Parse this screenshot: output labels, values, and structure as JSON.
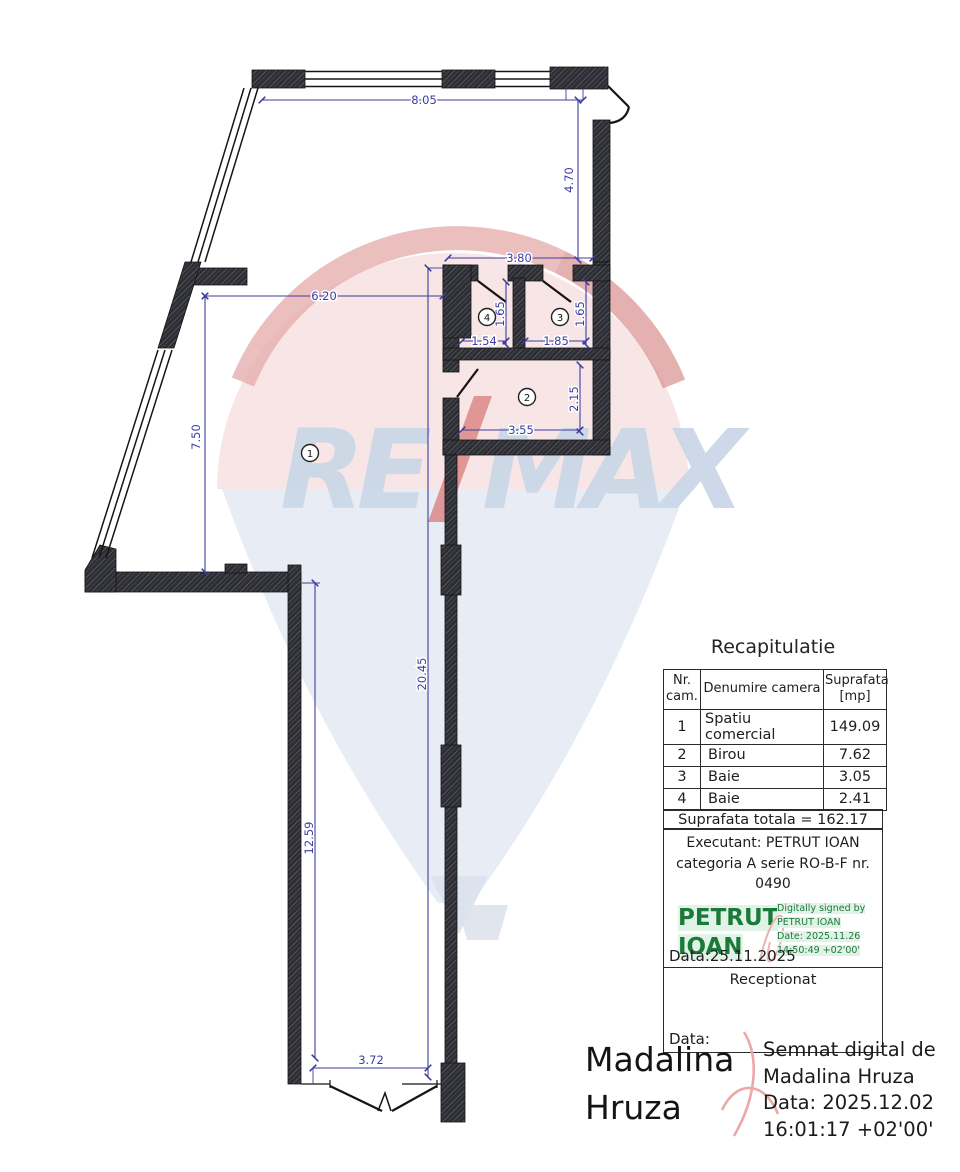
{
  "plan": {
    "dims": {
      "top_width": "8.05",
      "right_upper": "4.70",
      "bath_top": "3.80",
      "room1_width": "6.20",
      "room1_height": "7.50",
      "bath4_height": "1.65",
      "bath3_height": "1.65",
      "bath4_width": "1.54",
      "bath3_width": "1.85",
      "room2_height": "2.15",
      "room2_width": "3.55",
      "corridor_right": "20.45",
      "corridor_left": "12.59",
      "corridor_width": "3.72"
    },
    "rooms": {
      "r1": "1",
      "r2": "2",
      "r3": "3",
      "r4": "4"
    }
  },
  "watermark": {
    "left": "RE",
    "right": "MAX"
  },
  "recap": {
    "title": "Recapitulatie",
    "headers": {
      "nr": "Nr. cam.",
      "name": "Denumire camera",
      "area": "Suprafata [mp]"
    },
    "rows": [
      {
        "nr": "1",
        "name": "Spatiu comercial",
        "area": "149.09"
      },
      {
        "nr": "2",
        "name": "Birou",
        "area": "7.62"
      },
      {
        "nr": "3",
        "name": "Baie",
        "area": "3.05"
      },
      {
        "nr": "4",
        "name": "Baie",
        "area": "2.41"
      }
    ],
    "total": "Suprafata totala = 162.17",
    "executant_line1": "Executant: PETRUT IOAN",
    "executant_line2": "categoria A serie RO-B-F nr. 0490",
    "date_line": "Data:25.11.2025",
    "receptionat": "Receptionat",
    "data_label": "Data:"
  },
  "digital_signature": {
    "name": "PETRUT IOAN",
    "l1": "Digitally signed by",
    "l2": "PETRUT IOAN",
    "l3": "Date: 2025.11.26",
    "l4": "14:50:49 +02'00'"
  },
  "bottom_signature": {
    "name": "Madalina Hruza",
    "l1": "Semnat digital de",
    "l2": "Madalina Hruza",
    "l3": "Data: 2025.12.02",
    "l4": "16:01:17 +02'00'"
  },
  "colors": {
    "dimension": "#3d3da0",
    "wall": "#2d2d34",
    "signature_green": "#1b7a3a",
    "signature_green_bg": "#e1f2e6",
    "signature_red": "#e8a5a5",
    "watermark_blue": "#cbd8e8",
    "watermark_pink": "#f6dfdf"
  }
}
